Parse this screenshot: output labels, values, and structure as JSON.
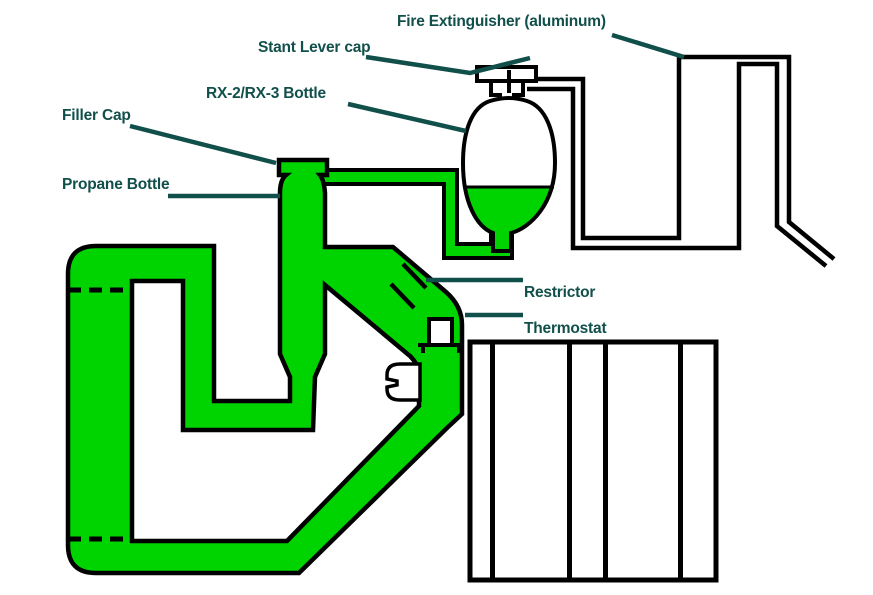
{
  "colors": {
    "pipe_fill": "#00d400",
    "label": "#114f4b",
    "outline": "#000000",
    "background": "#ffffff"
  },
  "labels": {
    "fire_extinguisher": "Fire Extinguisher (aluminum)",
    "stant_lever_cap": "Stant Lever cap",
    "rx_bottle": "RX-2/RX-3 Bottle",
    "filler_cap": "Filler Cap",
    "propane_bottle": "Propane Bottle",
    "restrictor": "Restrictor",
    "thermostat": "Thermostat"
  }
}
